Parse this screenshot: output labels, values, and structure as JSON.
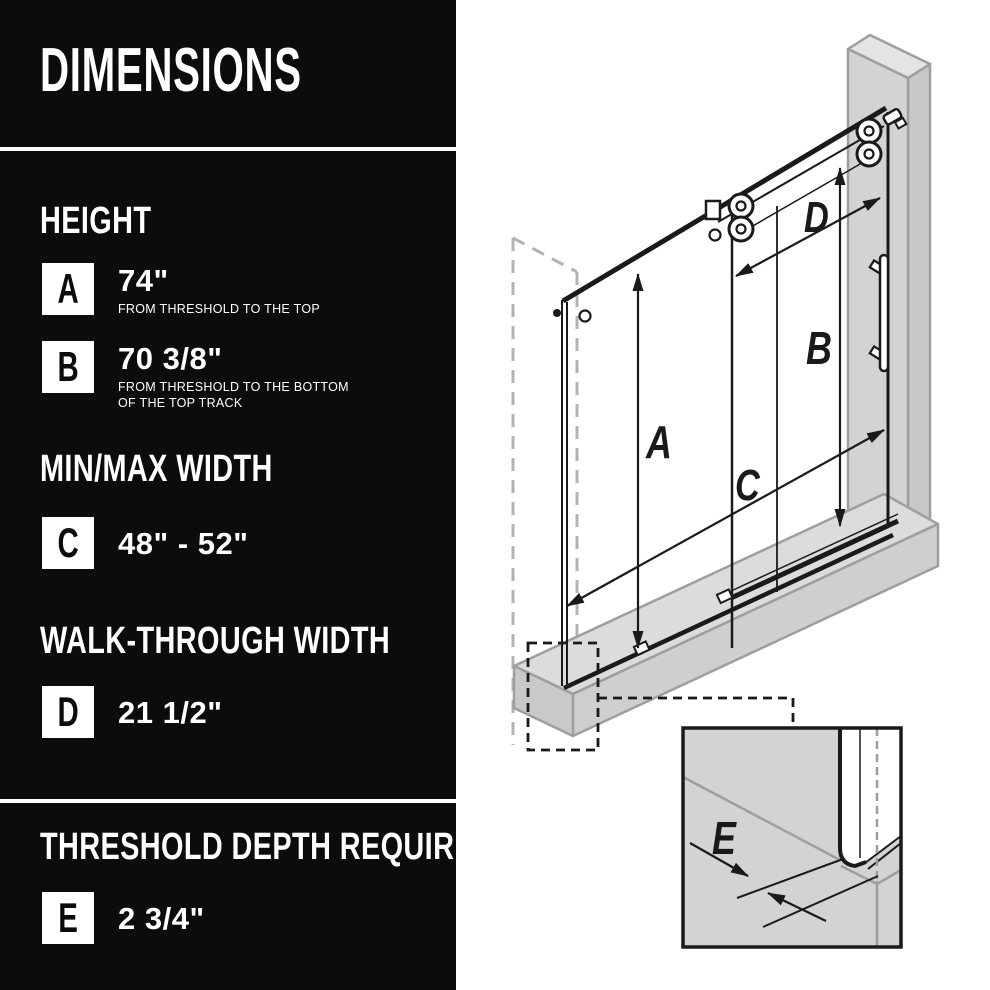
{
  "sidebar": {
    "title": "DIMENSIONS",
    "sections": [
      {
        "heading": "HEIGHT",
        "rows": [
          {
            "letter": "A",
            "value": "74\"",
            "desc_lines": [
              "FROM THRESHOLD TO THE TOP"
            ]
          },
          {
            "letter": "B",
            "value": "70 3/8\"",
            "desc_lines": [
              "FROM THRESHOLD TO THE BOTTOM",
              "OF THE TOP TRACK"
            ]
          }
        ]
      },
      {
        "heading": "MIN/MAX WIDTH",
        "rows": [
          {
            "letter": "C",
            "value": "48\" - 52\""
          }
        ]
      },
      {
        "heading": "WALK-THROUGH WIDTH",
        "rows": [
          {
            "letter": "D",
            "value": "21 1/2\""
          }
        ]
      },
      {
        "heading": "THRESHOLD DEPTH REQUIRED",
        "rows": [
          {
            "letter": "E",
            "value": "2 3/4\""
          }
        ]
      }
    ]
  },
  "diagram": {
    "labels": {
      "height_a": "A",
      "height_b": "B",
      "width_c": "C",
      "walkthrough_d": "D",
      "threshold_e": "E"
    }
  },
  "colors": {
    "sidebar_bg": "#0c0c0c",
    "sidebar_text": "#ffffff",
    "divider": "#ffffff",
    "line": "#1a1a1a",
    "wall_front": "#d3d3d3",
    "wall_top": "#e4e4e4",
    "wall_side": "#c7c7c7",
    "threshold_top": "#dcdcdc",
    "threshold_front": "#cfcfcf",
    "gray_edge": "#9e9e9e"
  }
}
